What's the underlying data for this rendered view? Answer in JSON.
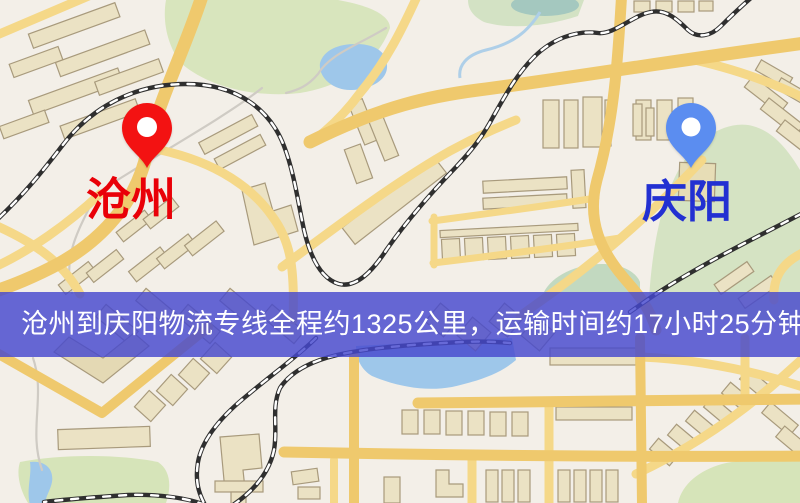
{
  "map": {
    "origin": {
      "label": "沧州",
      "pin_color": "#f31212",
      "label_color": "#e90008"
    },
    "destination": {
      "label": "庆阳",
      "pin_color": "#5b8df0",
      "label_color": "#2230d2"
    }
  },
  "banner": {
    "text": "沧州到庆阳物流专线全程约1325公里，运输时间约17小时25分钟.",
    "background_color": "#4648ce",
    "text_color": "#ffffff"
  }
}
